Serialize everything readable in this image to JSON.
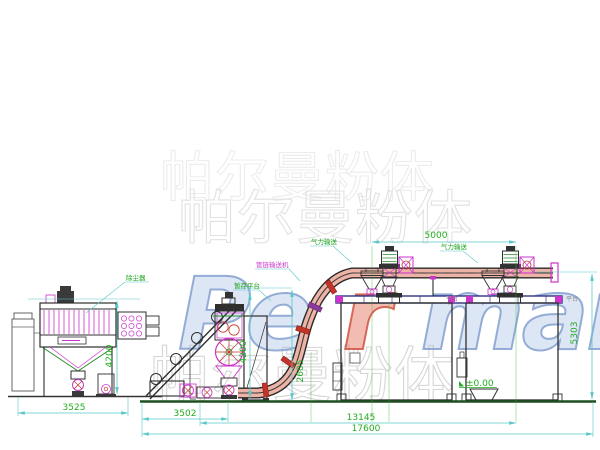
{
  "watermark": {
    "brand_en_part1": "Pe",
    "brand_en_part2": "r",
    "brand_en_part3": "man",
    "brand_cn_row1": "帕尔曼粉体",
    "brand_cn_row2": "帕尔曼粉体",
    "brand_cn_row3": "帕尔曼粉体"
  },
  "equipment_labels": {
    "dust_collector": "除尘器",
    "buffer_platform": "暂存平台",
    "tube_chain_conveyor": "管链输送机",
    "pneumatic_conveying_left": "气力输送",
    "pneumatic_conveying_right": "气力输送",
    "platform_left": "平台",
    "platform_right": "平台",
    "ground_level": "±0.00"
  },
  "dimensions": {
    "dust_collector_width": "3525",
    "dust_collector_height": "4200",
    "mill_height": "4200",
    "mill_bay_width": "3502",
    "conveyor_clearance": "2605",
    "feed_span": "5000",
    "silo_height": "5303",
    "process_span": "13145",
    "overall_length": "17600"
  },
  "colors": {
    "dimension_line": "#5ac8c8",
    "dimension_text": "#22ad22",
    "label_green": "#17a317",
    "label_magenta": "#cc33cc",
    "pipe_fill": "#edb3a6",
    "clamp_red": "#c2342a",
    "watermark_blue": "#8fadd6",
    "watermark_red": "#d4604e",
    "structure": "#2f2f2f"
  }
}
